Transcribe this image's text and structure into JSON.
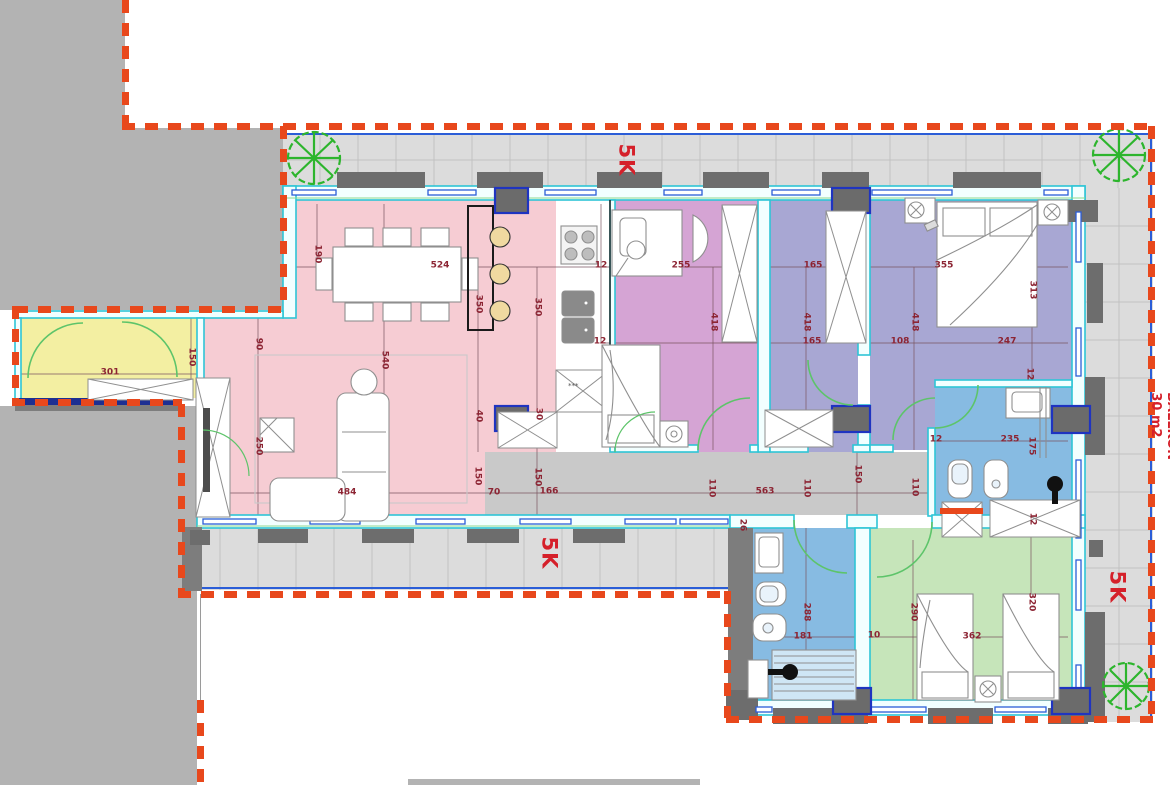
{
  "drawing": {
    "type": "apartment-floor-plan",
    "balcony_label": "BALLKON",
    "balcony_area": "30 m2",
    "zone_labels": [
      {
        "text": "5K",
        "x": 626,
        "y": 160
      },
      {
        "text": "5K",
        "x": 549,
        "y": 553
      },
      {
        "text": "5K",
        "x": 1117,
        "y": 587
      }
    ],
    "dimensions": [
      {
        "t": "524",
        "x": 440,
        "y": 266,
        "r": 0
      },
      {
        "t": "12",
        "x": 601,
        "y": 266,
        "r": 0
      },
      {
        "t": "255",
        "x": 681,
        "y": 266,
        "r": 0
      },
      {
        "t": "165",
        "x": 813,
        "y": 266,
        "r": 0
      },
      {
        "t": "355",
        "x": 944,
        "y": 266,
        "r": 0
      },
      {
        "t": "190",
        "x": 317,
        "y": 254,
        "r": 90
      },
      {
        "t": "350",
        "x": 478,
        "y": 304,
        "r": 90
      },
      {
        "t": "350",
        "x": 537,
        "y": 307,
        "r": 90
      },
      {
        "t": "540",
        "x": 384,
        "y": 360,
        "r": 90
      },
      {
        "t": "90",
        "x": 258,
        "y": 344,
        "r": 90
      },
      {
        "t": "250",
        "x": 258,
        "y": 446,
        "r": 90
      },
      {
        "t": "150",
        "x": 191,
        "y": 357,
        "r": 90
      },
      {
        "t": "301",
        "x": 110,
        "y": 373,
        "r": 0
      },
      {
        "t": "418",
        "x": 713,
        "y": 322,
        "r": 90
      },
      {
        "t": "418",
        "x": 806,
        "y": 322,
        "r": 90
      },
      {
        "t": "418",
        "x": 914,
        "y": 322,
        "r": 90
      },
      {
        "t": "313",
        "x": 1032,
        "y": 290,
        "r": 90
      },
      {
        "t": "165",
        "x": 812,
        "y": 342,
        "r": 0
      },
      {
        "t": "108",
        "x": 900,
        "y": 342,
        "r": 0
      },
      {
        "t": "247",
        "x": 1007,
        "y": 342,
        "r": 0
      },
      {
        "t": "12",
        "x": 600,
        "y": 342,
        "r": 0
      },
      {
        "t": "12",
        "x": 1029,
        "y": 374,
        "r": 90
      },
      {
        "t": "235",
        "x": 1010,
        "y": 440,
        "r": 0
      },
      {
        "t": "175",
        "x": 1031,
        "y": 446,
        "r": 90
      },
      {
        "t": "12",
        "x": 936,
        "y": 440,
        "r": 0
      },
      {
        "t": "30",
        "x": 538,
        "y": 414,
        "r": 90
      },
      {
        "t": "40",
        "x": 478,
        "y": 416,
        "r": 90
      },
      {
        "t": "150",
        "x": 477,
        "y": 476,
        "r": 90
      },
      {
        "t": "70",
        "x": 494,
        "y": 493,
        "r": 0
      },
      {
        "t": "166",
        "x": 549,
        "y": 492,
        "r": 0
      },
      {
        "t": "150",
        "x": 537,
        "y": 477,
        "r": 90
      },
      {
        "t": "110",
        "x": 711,
        "y": 488,
        "r": 90
      },
      {
        "t": "563",
        "x": 765,
        "y": 492,
        "r": 0
      },
      {
        "t": "110",
        "x": 806,
        "y": 488,
        "r": 90
      },
      {
        "t": "150",
        "x": 857,
        "y": 474,
        "r": 90
      },
      {
        "t": "110",
        "x": 914,
        "y": 487,
        "r": 90
      },
      {
        "t": "26",
        "x": 742,
        "y": 525,
        "r": 90
      },
      {
        "t": "484",
        "x": 347,
        "y": 493,
        "r": 0
      },
      {
        "t": "288",
        "x": 806,
        "y": 612,
        "r": 90
      },
      {
        "t": "181",
        "x": 803,
        "y": 637,
        "r": 0
      },
      {
        "t": "10",
        "x": 874,
        "y": 636,
        "r": 0
      },
      {
        "t": "290",
        "x": 913,
        "y": 612,
        "r": 90
      },
      {
        "t": "362",
        "x": 972,
        "y": 637,
        "r": 0
      },
      {
        "t": "320",
        "x": 1031,
        "y": 602,
        "r": 90
      },
      {
        "t": "12",
        "x": 1032,
        "y": 519,
        "r": 90
      }
    ],
    "colors": {
      "living_pink": "#f6ccd3",
      "room_purple": "#d5a4d4",
      "room_periwinkle": "#a8a7d3",
      "entry_yellow": "#f3efa2",
      "bath_blue": "#87bbe2",
      "room_green": "#c6e5ba",
      "corridor_gray": "#c9c9c9",
      "balcony_gray": "#dcdcdc",
      "outside_gray": "#b3b3b3",
      "wall_cyan": "#2ec5d6",
      "boundary_red": "#e8481c",
      "dimension_text": "#8c2433",
      "window_blue": "#2b5dd7",
      "door_green": "#5dc46a",
      "tree_green": "#2db52d"
    }
  }
}
